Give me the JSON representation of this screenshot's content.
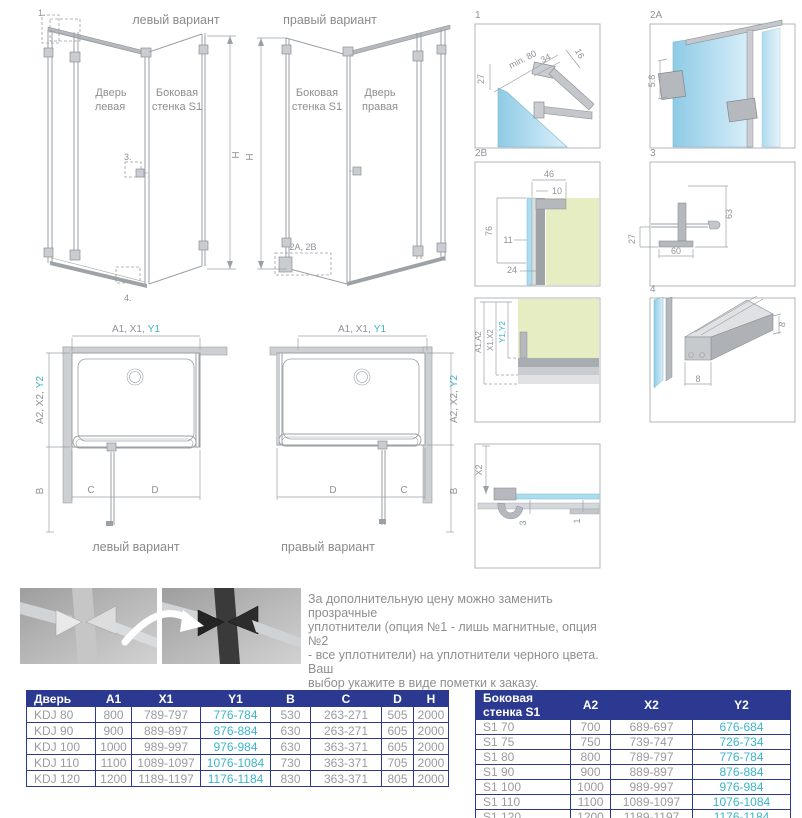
{
  "colors": {
    "table_header_bg": "#2b3990",
    "table_border": "#2b3990",
    "accent_teal": "#3cb4c7",
    "drawing_line": "#9aa0a6",
    "glass_blue": "#a9def1",
    "wall_green": "#e6edc3",
    "text_gray": "#8f8f8f"
  },
  "drawing_left": {
    "title": "левый вариант",
    "door_label_1": "Дверь",
    "door_label_2": "левая",
    "side_label_1": "Боковая",
    "side_label_2": "стенка S1",
    "callout_1": "1.",
    "callout_3": "3.",
    "callout_4": "4.",
    "dim_h": "H"
  },
  "drawing_right": {
    "title": "правый вариант",
    "side_label_1": "Боковая",
    "side_label_2": "стенка S1",
    "door_label_1": "Дверь",
    "door_label_2": "правая",
    "callout_2ab": "2A, 2B",
    "dim_h": "H"
  },
  "details": {
    "d1": {
      "label": "1",
      "dim_min80": "min. 80",
      "dim_34": "34",
      "dim_16": "16",
      "dim_27": "27"
    },
    "d2a": {
      "label": "2A",
      "dim_58": "5.8"
    },
    "d2b": {
      "label": "2B",
      "dim_46": "46",
      "dim_10": "10",
      "dim_76": "76",
      "dim_11": "11",
      "dim_24": "24"
    },
    "d3": {
      "label": "3",
      "dim_63": "63",
      "dim_27": "27",
      "dim_60": "60"
    },
    "dwall": {
      "dim_a": "A1,A2",
      "dim_x": "X1,X2",
      "dim_y": "Y1,Y2"
    },
    "d4": {
      "label": "4",
      "dim_8a": "8",
      "dim_8b": "8"
    },
    "dx2": {
      "dim_x2": "X2",
      "dim_3": "3",
      "dim_1": "1"
    }
  },
  "plan_left": {
    "dim_top": "A1, X1,",
    "dim_top_accent": "Y1",
    "dim_side": "A2, X2,",
    "dim_side_accent": "Y2",
    "dim_b": "B",
    "dim_c": "C",
    "dim_d": "D",
    "caption": "левый вариант"
  },
  "plan_right": {
    "dim_top": "A1, X1,",
    "dim_top_accent": "Y1",
    "dim_side": "A2, X2,",
    "dim_side_accent": "Y2",
    "dim_b": "B",
    "dim_c": "C",
    "dim_d": "D",
    "caption": "правый вариант"
  },
  "note": {
    "line1": "За дополнительную цену можно заменить прозрачные",
    "line2": "уплотнители (опция №1 - лишь магнитные, опция №2",
    "line3": "- все уплотнители) на уплотнители черного цвета. Ваш",
    "line4": "выбор укажите в виде пометки к заказу."
  },
  "door_table": {
    "headers": [
      "Дверь",
      "A1",
      "X1",
      "Y1",
      "B",
      "C",
      "D",
      "H"
    ],
    "rows": [
      [
        "KDJ 80",
        "800",
        "789-797",
        "776-784",
        "530",
        "263-271",
        "505",
        "2000"
      ],
      [
        "KDJ 90",
        "900",
        "889-897",
        "876-884",
        "630",
        "263-271",
        "605",
        "2000"
      ],
      [
        "KDJ 100",
        "1000",
        "989-997",
        "976-984",
        "630",
        "363-371",
        "605",
        "2000"
      ],
      [
        "KDJ 110",
        "1100",
        "1089-1097",
        "1076-1084",
        "730",
        "363-371",
        "705",
        "2000"
      ],
      [
        "KDJ 120",
        "1200",
        "1189-1197",
        "1176-1184",
        "830",
        "363-371",
        "805",
        "2000"
      ]
    ]
  },
  "side_table": {
    "headers": [
      "Боковая стенка S1",
      "A2",
      "X2",
      "Y2"
    ],
    "rows": [
      [
        "S1 70",
        "700",
        "689-697",
        "676-684"
      ],
      [
        "S1 75",
        "750",
        "739-747",
        "726-734"
      ],
      [
        "S1 80",
        "800",
        "789-797",
        "776-784"
      ],
      [
        "S1 90",
        "900",
        "889-897",
        "876-884"
      ],
      [
        "S1 100",
        "1000",
        "989-997",
        "976-984"
      ],
      [
        "S1 110",
        "1100",
        "1089-1097",
        "1076-1084"
      ],
      [
        "S1 120",
        "1200",
        "1189-1197",
        "1176-1184"
      ]
    ]
  }
}
